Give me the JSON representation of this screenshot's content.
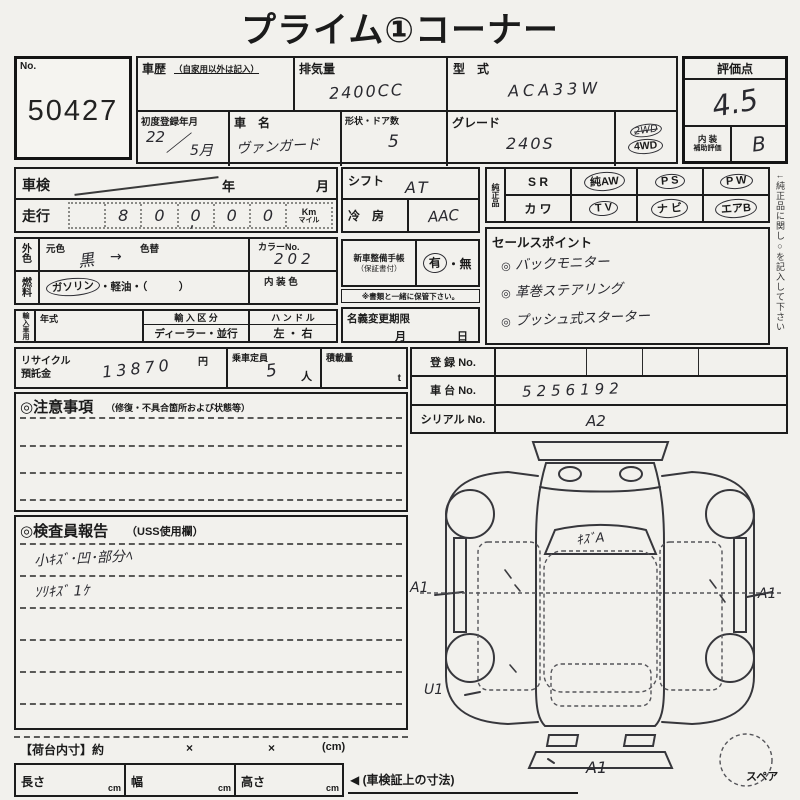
{
  "title": "プライム①コーナー",
  "no": {
    "label": "No.",
    "value": "50427"
  },
  "rating": {
    "header": "評価点",
    "score": "4.5",
    "interior_label_1": "内 装",
    "interior_label_2": "補助評価",
    "interior_grade": "B"
  },
  "toprow": {
    "history_label": "車歴",
    "history_note": "（自家用以外は記入）",
    "disp_label": "排気量",
    "disp_value": "2400CC",
    "model_label": "型　式",
    "model_value": "ACA33W",
    "firstreg_label": "初度登録年月",
    "firstreg_num": "22",
    "firstreg_slash": "／",
    "firstreg_month": "5月",
    "name_label": "車　名",
    "name_value": "ヴァンガード",
    "doors_label": "形状・ドア数",
    "doors_value": "5",
    "grade_label": "グレード",
    "grade_value": "240S",
    "drive_crossed": "2WD",
    "drive_circled": "4WD"
  },
  "inspection": {
    "label": "車検",
    "year_label": "年",
    "month_label": "月"
  },
  "mileage": {
    "label": "走行",
    "digits": [
      "",
      "8",
      "0",
      "0",
      "0",
      "0"
    ],
    "comma": ",",
    "unit_km": "Km",
    "unit_mile": "マイル"
  },
  "color": {
    "label_1": "外",
    "label_2": "色",
    "orig_label": "元色",
    "repaint_label": "色替",
    "value": "黒",
    "arrow": "→",
    "colorno_label": "カラーNo.",
    "colorno_value": "202"
  },
  "fuel": {
    "label_1": "燃",
    "label_2": "料",
    "circled": "ガソリン",
    "rest": "・軽油・（　　　）",
    "interior_label": "内 装 色"
  },
  "importcar": {
    "label": "輸入車用",
    "year_label": "年式",
    "class_label": "輸 入 区 分",
    "class_value": "ディーラー・並行",
    "handle_label": "ハ ン ド ル",
    "handle_value": "左 ・ 右"
  },
  "shift": {
    "label": "シフト",
    "value": "AT"
  },
  "ac": {
    "label": "冷　房",
    "value": "AAC"
  },
  "servicebook": {
    "label_1": "新車整備手帳",
    "label_2": "（保証書付）",
    "yes": "有",
    "sep": "・",
    "no": "無",
    "note": "※書類と一緒に保管下さい。"
  },
  "transfer": {
    "label": "名義変更期限",
    "month_label": "月",
    "day_label": "日"
  },
  "equip": {
    "label": "純正品",
    "r1c0": "S R",
    "r1c1": "純AW",
    "r1c2": "P S",
    "r1c3": "P W",
    "r2c0": "カ ワ",
    "r2c1": "T V",
    "r2c2": "ナ ビ",
    "r2c3": "エアB"
  },
  "sales": {
    "header": "セールスポイント",
    "bullet": "◎",
    "items": [
      "バックモニター",
      "革巻ステアリング",
      "プッシュ式スターター"
    ]
  },
  "recycle": {
    "label_1": "リサイクル",
    "label_2": "預託金",
    "value": "13870",
    "yen": "円",
    "cap_label": "乗車定員",
    "cap_value": "5",
    "cap_unit": "人",
    "load_label": "積載量",
    "load_unit": "t"
  },
  "registration": {
    "reg_label": "登 録 No.",
    "chassis_label": "車 台 No.",
    "chassis_value": "5256192",
    "serial_label": "シリアル No."
  },
  "caution": {
    "header": "◎注意事項",
    "note": "（修復・不具合箇所および状態等）"
  },
  "inspector": {
    "header": "◎検査員報告",
    "note": "（USS使用欄）",
    "line1": "小ｷｽﾞ･凹･部分ﾍ",
    "line2": "ｿﾘｷｽﾞ 1ｹ"
  },
  "diagram": {
    "mark_top": "A2",
    "mark_windshield": "ｷｽﾞA",
    "mark_left": "A1",
    "mark_right": "A1",
    "mark_bottom_left": "U1",
    "mark_bottom": "A1",
    "spare_label": "スペア"
  },
  "bed": {
    "label": "【荷台内寸】約",
    "x1": "×",
    "x2": "×",
    "cm": "(cm)"
  },
  "dims": {
    "length_label": "長さ",
    "width_label": "幅",
    "height_label": "高さ",
    "unit": "cm",
    "note": "◀ (車検証上の寸法)"
  },
  "sidenote": "←純正品に関し○を記入して下さい"
}
